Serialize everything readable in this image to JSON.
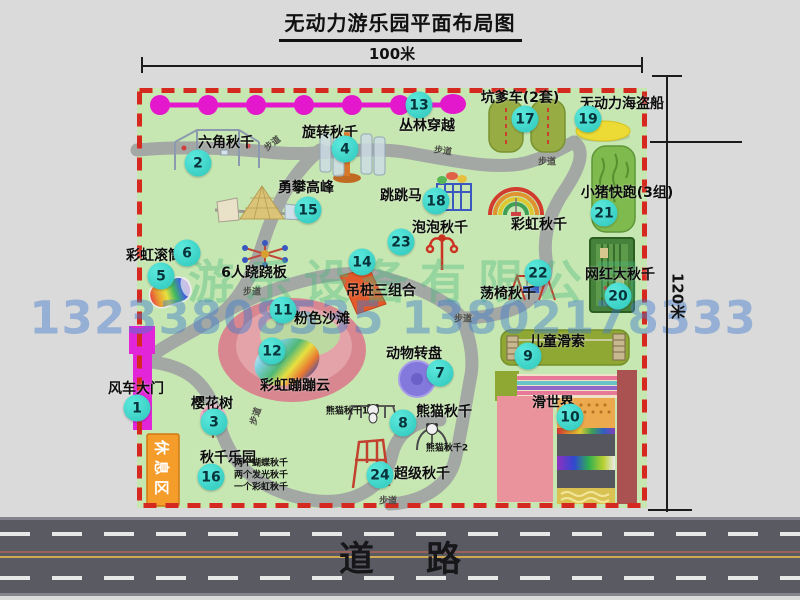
{
  "title": "无动力游乐园平面布局图",
  "dimensions": {
    "width": "100米",
    "height": "120米"
  },
  "road": {
    "label": "道路"
  },
  "watermark": {
    "company": "游乐设备有限公司",
    "phone": "13233808535 13802178333"
  },
  "map": {
    "walk_label": "步道",
    "rest_area_label": "休息区",
    "attractions": [
      {
        "num": "1",
        "name": "风车大门",
        "bx": 0,
        "by": 320,
        "lx": -1,
        "ly": 300
      },
      {
        "num": "2",
        "name": "六角秋千",
        "bx": 61,
        "by": 75,
        "lx": 89,
        "ly": 54
      },
      {
        "num": "3",
        "name": "樱花树",
        "bx": 77,
        "by": 334,
        "lx": 75,
        "ly": 315
      },
      {
        "num": "4",
        "name": "旋转秋千",
        "bx": 208,
        "by": 61,
        "lx": 193,
        "ly": 44
      },
      {
        "num": "5",
        "name": "彩虹滚筒",
        "bx": 24,
        "by": 188,
        "lx": 17,
        "ly": 167
      },
      {
        "num": "6",
        "name": "6人跷跷板",
        "bx": 50,
        "by": 165,
        "lx": 117,
        "ly": 184
      },
      {
        "num": "7",
        "name": "动物转盘",
        "bx": 303,
        "by": 285,
        "lx": 277,
        "ly": 265
      },
      {
        "num": "8",
        "name": "熊猫秋千",
        "bx": 266,
        "by": 335,
        "lx": 307,
        "ly": 323
      },
      {
        "num": "9",
        "name": "儿童滑索",
        "bx": 391,
        "by": 268,
        "lx": 420,
        "ly": 253
      },
      {
        "num": "10",
        "name": "滑世界",
        "bx": 433,
        "by": 329,
        "lx": 416,
        "ly": 314
      },
      {
        "num": "11",
        "name": "粉色沙滩",
        "bx": 146,
        "by": 222,
        "lx": 185,
        "ly": 230
      },
      {
        "num": "12",
        "name": "彩虹蹦蹦云",
        "bx": 135,
        "by": 263,
        "lx": 158,
        "ly": 297
      },
      {
        "num": "13",
        "name": "丛林穿越",
        "bx": 282,
        "by": 17,
        "lx": 290,
        "ly": 37
      },
      {
        "num": "14",
        "name": "吊桩三组合",
        "bx": 225,
        "by": 174,
        "lx": 244,
        "ly": 202
      },
      {
        "num": "15",
        "name": "勇攀高峰",
        "bx": 171,
        "by": 122,
        "lx": 169,
        "ly": 99
      },
      {
        "num": "16",
        "name": "秋千乐园",
        "bx": 74,
        "by": 389,
        "lx": 91,
        "ly": 369
      },
      {
        "num": "17",
        "name": "坑爹车(2套)",
        "bx": 388,
        "by": 31,
        "lx": 383,
        "ly": 9
      },
      {
        "num": "18",
        "name": "跳跳马",
        "bx": 299,
        "by": 113,
        "lx": 264,
        "ly": 107
      },
      {
        "num": "19",
        "name": "无动力海盗船",
        "bx": 451,
        "by": 31,
        "lx": 485,
        "ly": 15
      },
      {
        "num": "20",
        "name": "网红大秋千",
        "bx": 481,
        "by": 208,
        "lx": 483,
        "ly": 186
      },
      {
        "num": "21",
        "name": "小猪快跑(3组)",
        "bx": 467,
        "by": 125,
        "lx": 490,
        "ly": 104
      },
      {
        "num": "22",
        "name": "荡椅秋千",
        "bx": 401,
        "by": 185,
        "lx": 371,
        "ly": 205
      },
      {
        "num": "23",
        "name": "泡泡秋千",
        "bx": 264,
        "by": 154,
        "lx": 303,
        "ly": 139
      },
      {
        "num": "24",
        "name": "超级秋千",
        "bx": 243,
        "by": 387,
        "lx": 285,
        "ly": 385
      },
      {
        "num": "",
        "name": "彩虹秋千",
        "bx": null,
        "by": null,
        "lx": 402,
        "ly": 136
      }
    ],
    "sub_labels": [
      {
        "text": "熊猫秋千1",
        "x": 210,
        "y": 322
      },
      {
        "text": "熊猫秋千2",
        "x": 310,
        "y": 359
      },
      {
        "text": "两个蝴蝶秋千",
        "x": 124,
        "y": 374
      },
      {
        "text": "两个发光秋千",
        "x": 124,
        "y": 386
      },
      {
        "text": "一个彩虹秋千",
        "x": 124,
        "y": 398
      }
    ],
    "walk_positions": [
      {
        "x": 135,
        "y": 55,
        "rot": -38
      },
      {
        "x": 306,
        "y": 62,
        "rot": 8
      },
      {
        "x": 410,
        "y": 73,
        "rot": 0
      },
      {
        "x": 115,
        "y": 203,
        "rot": 0
      },
      {
        "x": 326,
        "y": 230,
        "rot": 0
      },
      {
        "x": 118,
        "y": 328,
        "rot": -72
      },
      {
        "x": 251,
        "y": 412,
        "rot": 0
      }
    ]
  }
}
